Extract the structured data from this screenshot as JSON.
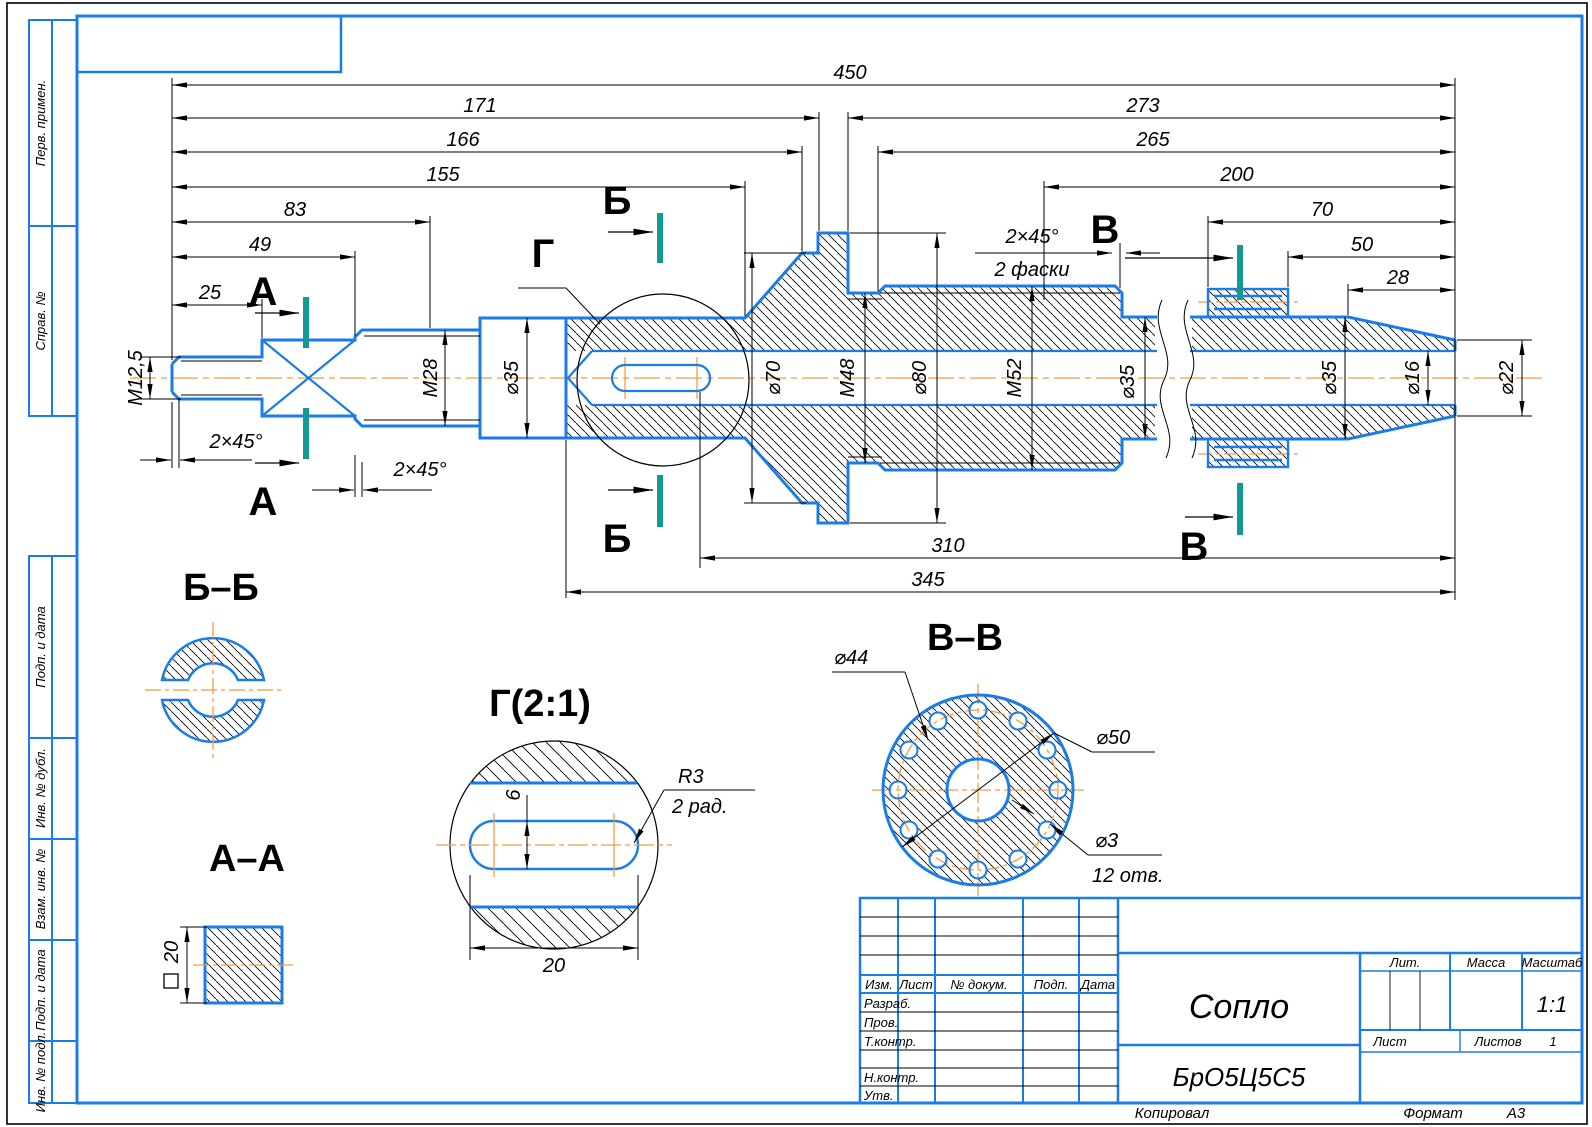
{
  "colors": {
    "blue": "#1a7ce8",
    "orange": "#f79b44",
    "teal": "#129a96",
    "black": "#000000"
  },
  "strip": {
    "items": [
      "Перв. примен.",
      "Справ. №",
      "Подп. и дата",
      "Инв. № дубл.",
      "Взам. инв. №",
      "Подп. и дата",
      "Инв. № подл."
    ]
  },
  "dims": {
    "len450": "450",
    "len171": "171",
    "len273": "273",
    "len166": "166",
    "len265": "265",
    "len155": "155",
    "len200": "200",
    "len83": "83",
    "len70": "70",
    "len49": "49",
    "len50": "50",
    "len25": "25",
    "len28": "28",
    "len310": "310",
    "len345": "345",
    "m125": "М12,5",
    "m28": "М28",
    "d35a": "⌀35",
    "d70": "⌀70",
    "m48": "М48",
    "d80": "⌀80",
    "m52": "М52",
    "d35b": "⌀35",
    "d35c": "⌀35",
    "d16": "⌀16",
    "d22": "⌀22",
    "ch_left": "2×45°",
    "ch_m28": "2×45°",
    "ch_right": "2×45°",
    "ch_right_note": "2 фаски"
  },
  "marks": {
    "a": "А",
    "b": "Б",
    "v": "В",
    "g": "Г"
  },
  "views": {
    "bb": {
      "title": "Б–Б"
    },
    "aa": {
      "title": "А–А",
      "side": "20"
    },
    "g2": {
      "title": "Г(2:1)",
      "width": "6",
      "length": "20",
      "r": "R3",
      "rnote": "2 рад."
    },
    "vv": {
      "title": "В–В",
      "bolt": "⌀44",
      "outer": "⌀50",
      "hole": "⌀3",
      "count": "12 отв."
    }
  },
  "tb": {
    "h": {
      "izm": "Изм.",
      "list": "Лист",
      "doc": "№ докум.",
      "podp": "Подп.",
      "data": "Дата"
    },
    "rows": [
      "Разраб.",
      "Пров.",
      "Т.контр.",
      "Н.контр.",
      "Утв."
    ],
    "name": "Сопло",
    "material": "БрО5Ц5С5",
    "lit": "Лит.",
    "massa": "Масса",
    "masshtab": "Масштаб",
    "scale": "1:1",
    "list2": "Лист",
    "listov": "Листов",
    "listov_val": "1"
  },
  "footer": {
    "copy": "Копировал",
    "format_label": "Формат",
    "format": "А3"
  }
}
